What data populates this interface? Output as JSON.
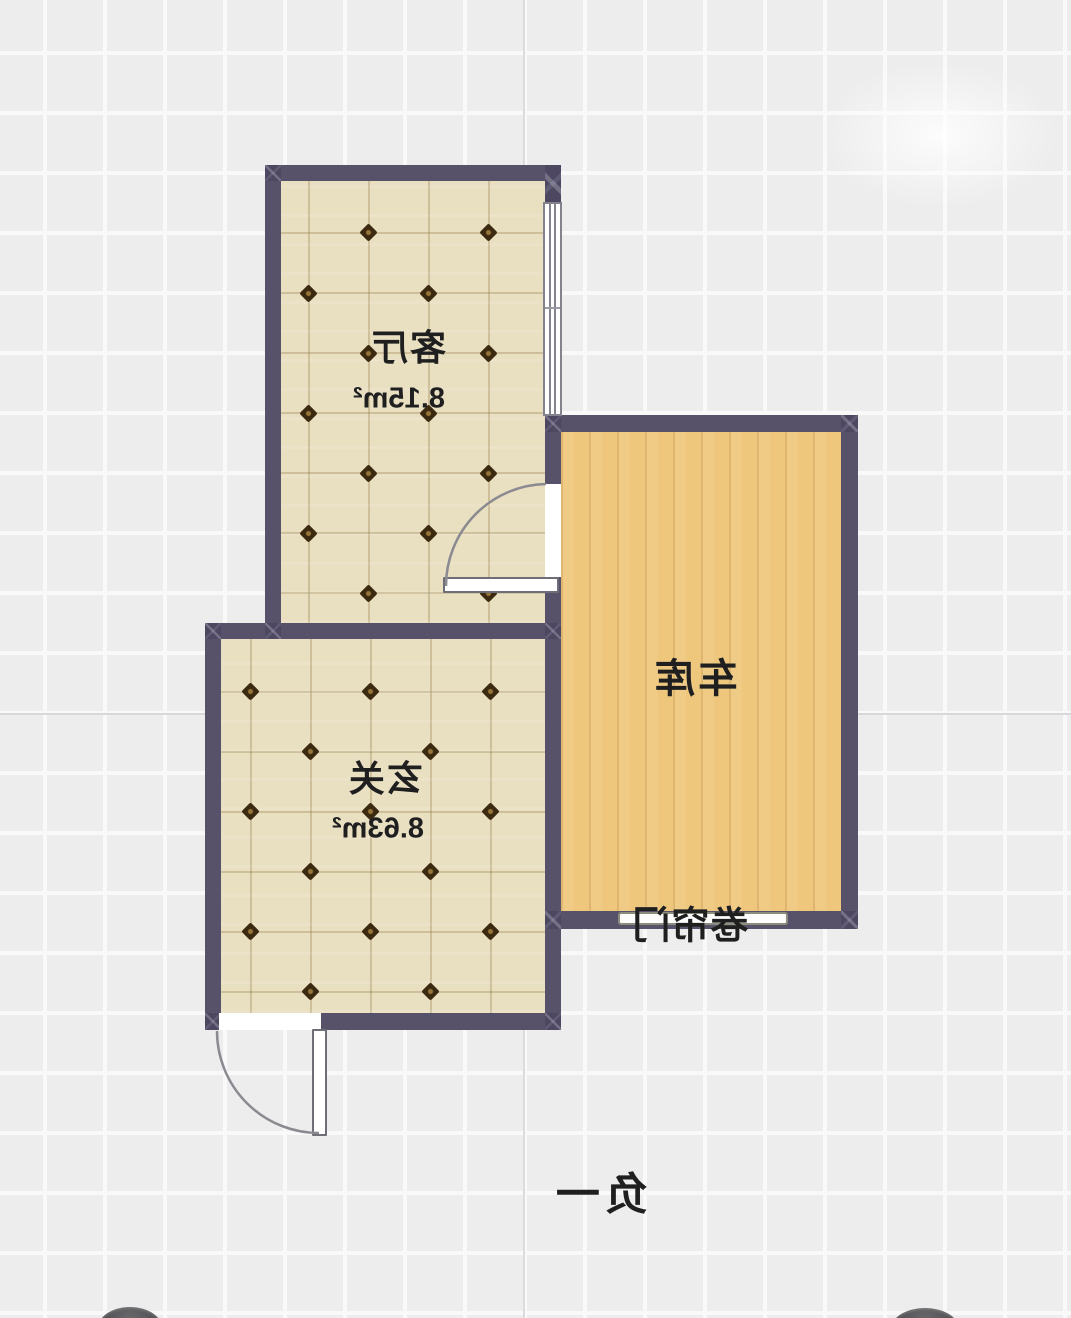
{
  "floor_plan": {
    "level_label": "负一",
    "rooms": [
      {
        "id": "living-room",
        "name": "客厅",
        "area": "8.15m²"
      },
      {
        "id": "entryway",
        "name": "玄关",
        "area": "8.63m²"
      },
      {
        "id": "garage",
        "name": "车库",
        "area": ""
      }
    ],
    "doors": {
      "rolling_door_label": "卷帘门"
    },
    "colors": {
      "wall": "#57516a",
      "tile_floor": "#e9dfc1",
      "wood_floor": "#eec77d",
      "background": "#ededee",
      "text": "#1f1f1f"
    }
  }
}
